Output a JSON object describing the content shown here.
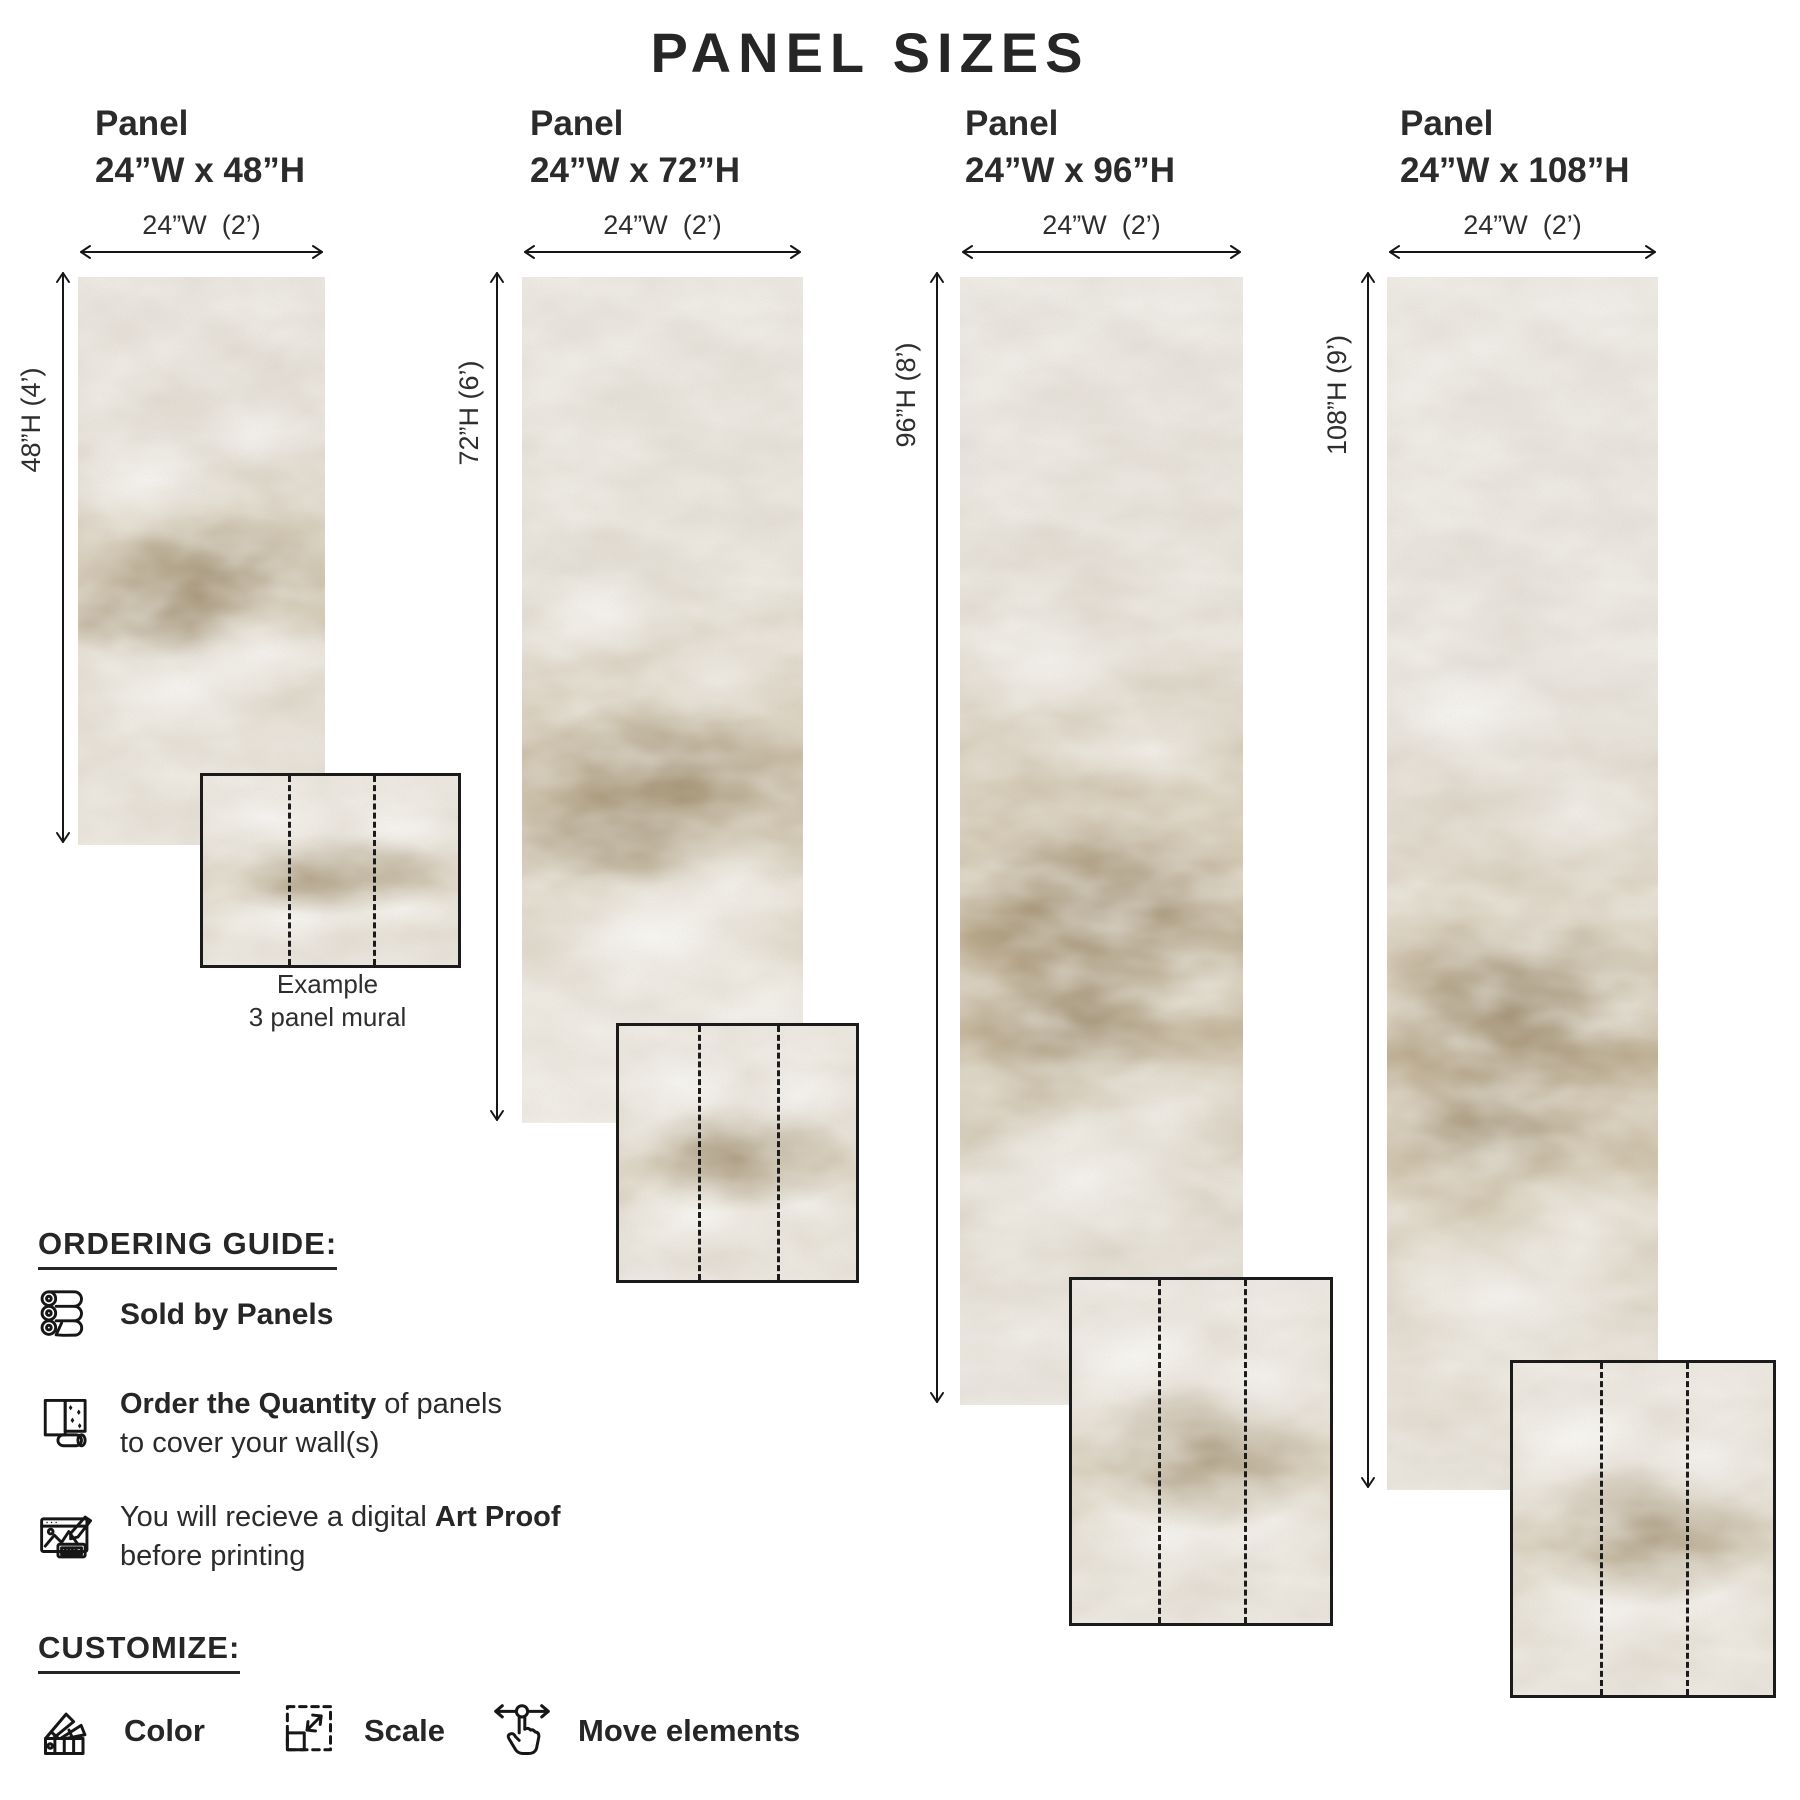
{
  "title": "PANEL SIZES",
  "panels": [
    {
      "name": "Panel",
      "size": "24”W x 48”H",
      "width_label": "24”W  (2’)",
      "height_label": "48”H (4’)"
    },
    {
      "name": "Panel",
      "size": "24”W x 72”H",
      "width_label": "24”W  (2’)",
      "height_label": "72”H (6’)"
    },
    {
      "name": "Panel",
      "size": "24”W x 96”H",
      "width_label": "24”W  (2’)",
      "height_label": "96”H (8’)"
    },
    {
      "name": "Panel",
      "size": "24”W x 108”H",
      "width_label": "24”W  (2’)",
      "height_label": "108”H (9’)"
    }
  ],
  "example": {
    "line1": "Example",
    "line2": "3 panel mural"
  },
  "ordering_guide": {
    "heading": "ORDERING GUIDE:",
    "item1": {
      "icon": "panel-rolls-icon",
      "bold": "Sold by Panels"
    },
    "item2": {
      "icon": "wallpaper-quantity-icon",
      "bold": "Order the Quantity",
      "rest": " of panels",
      "line2": "to cover your wall(s)"
    },
    "item3": {
      "icon": "art-proof-icon",
      "pre": "You will recieve a digital ",
      "bold": "Art Proof",
      "line2": "before printing"
    }
  },
  "customize": {
    "heading": "CUSTOMIZE:",
    "item1": {
      "icon": "color-swatches-icon",
      "label": "Color"
    },
    "item2": {
      "icon": "scale-icon",
      "label": "Scale"
    },
    "item3": {
      "icon": "move-elements-icon",
      "label": "Move elements"
    }
  },
  "colors": {
    "text": "#262626",
    "panel_base": "#e7e2d9",
    "panel_tan": "#b5a68a",
    "line": "#222222"
  }
}
